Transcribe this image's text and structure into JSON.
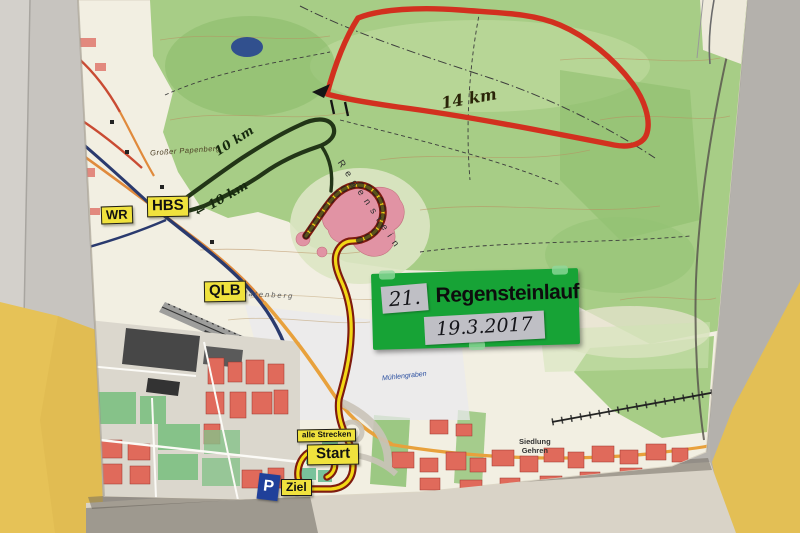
{
  "sign": {
    "race_number": "21.",
    "title": "Regensteinlauf",
    "date": "19.3.2017"
  },
  "junction_labels": {
    "wr": "WR",
    "hbs": "HBS",
    "qlb": "QLB"
  },
  "course_markers": {
    "all_courses": "alle Strecken",
    "start": "Start",
    "finish": "Ziel",
    "parking": "P"
  },
  "distance_labels": {
    "long_course": "14 km",
    "short_course_upper": "10 km",
    "short_course_lower": "10 km",
    "direction_arrow": "←"
  },
  "place_names": {
    "hill_northwest": "Großer Papenberg",
    "rock_ridge": "Regenstein",
    "hill_west": "Platenberg",
    "settlement_line1": "Siedlung",
    "settlement_line2": "Gehren",
    "stream": "Mühlengraben"
  },
  "colors": {
    "long_course_route": "#d2301f",
    "short_course_route": "#223517",
    "common_route_fill": "#f2d716",
    "common_route_outline": "#7e1b0f",
    "marker_label_background": "#f0e23d",
    "sign_green": "#17a336",
    "parking_blue": "#20409a",
    "wall_yellow": "#e6c257",
    "forest_green": "#a7cd86"
  }
}
